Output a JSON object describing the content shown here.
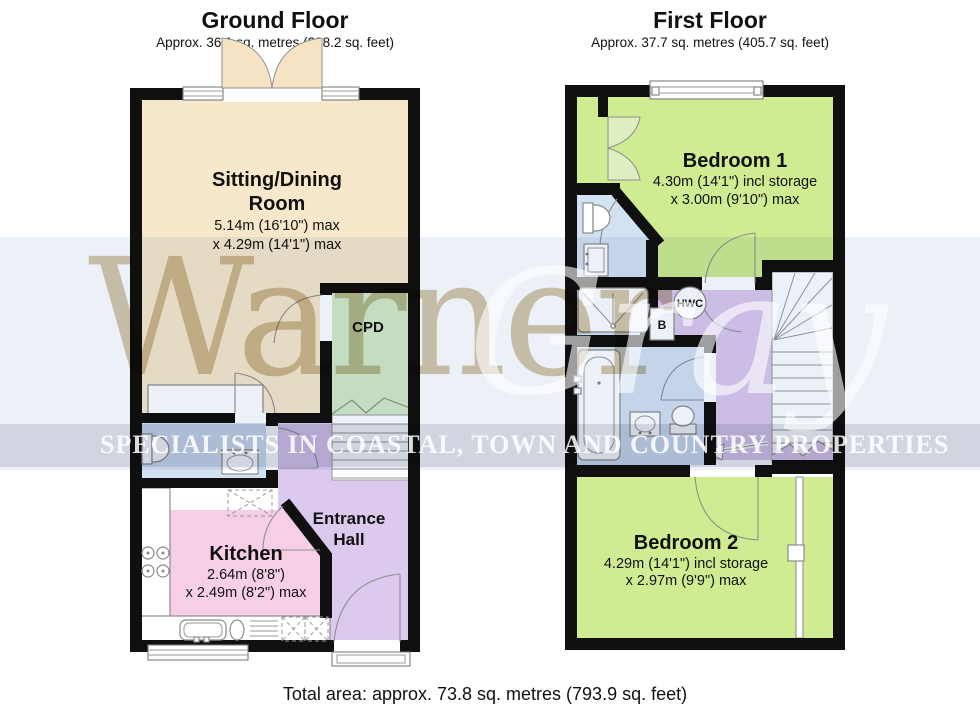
{
  "ground_floor": {
    "title": "Ground Floor",
    "area": "Approx. 36.1 sq. metres (388.2 sq. feet)",
    "rooms": {
      "sitting": {
        "line1": "Sitting/Dining",
        "line2": "Room",
        "dim1": "5.14m (16'10\") max",
        "dim2": "x 4.29m (14'1\") max"
      },
      "cpd": {
        "name": "CPD"
      },
      "kitchen": {
        "name": "Kitchen",
        "dim1": "2.64m (8'8\")",
        "dim2": "x 2.49m (8'2\") max"
      },
      "entrance_hall": {
        "line1": "Entrance",
        "line2": "Hall"
      }
    }
  },
  "first_floor": {
    "title": "First Floor",
    "area": "Approx. 37.7 sq. metres (405.7 sq. feet)",
    "rooms": {
      "bedroom1": {
        "name": "Bedroom 1",
        "dim1": "4.30m (14'1\") incl storage",
        "dim2": "x 3.00m (9'10\") max"
      },
      "bedroom2": {
        "name": "Bedroom 2",
        "dim1": "4.29m (14'1\") incl storage",
        "dim2": "x 2.97m (9'9\") max"
      },
      "hwc": {
        "label": "HWC"
      },
      "boiler": {
        "label": "B"
      }
    }
  },
  "footer": {
    "total_area": "Total area: approx. 73.8 sq. metres (793.9 sq. feet)"
  },
  "watermark": {
    "word1": "Warner",
    "word2": "Gray",
    "tagline": "SPECIALISTS IN COASTAL, TOWN AND COUNTRY PROPERTIES"
  },
  "colors": {
    "sitting_room": "#f8e8cb",
    "cpd": "#d4eac6",
    "bedroom_green": "#cfec92",
    "hall_purple": "#dcc9ee",
    "bathroom_blue": "#d3e2f3",
    "kitchen_pink": "#f6cfe6",
    "wall_black": "#101010",
    "watermark_tan": "#d5c8ac"
  }
}
